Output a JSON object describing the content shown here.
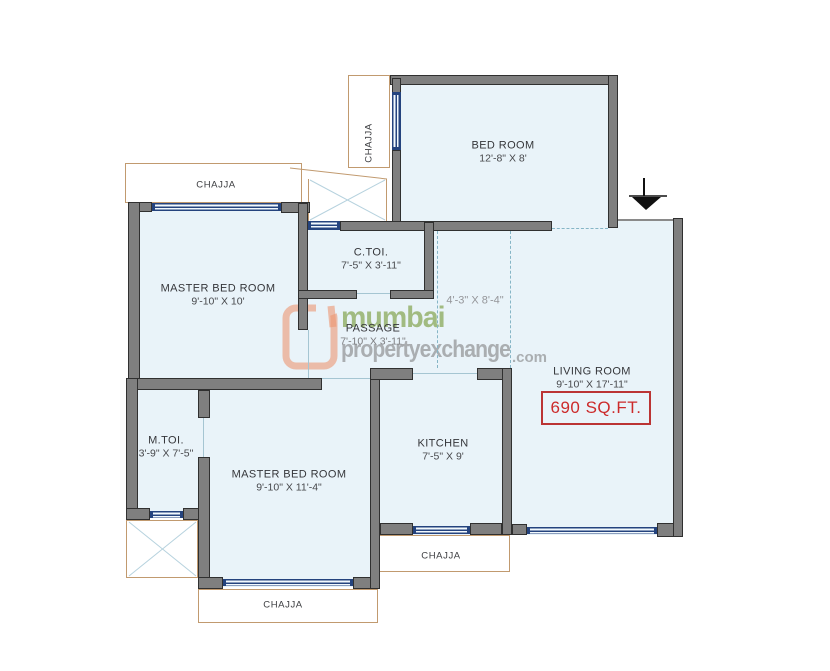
{
  "plan": {
    "area_badge": "690 SQ.FT.",
    "chajja_label": "CHAJJA",
    "rooms": {
      "bedroom": {
        "name": "BED ROOM",
        "dims": "12'-8\" X 8'"
      },
      "master_bed_top": {
        "name": "MASTER BED ROOM",
        "dims": "9'-10\" X 10'"
      },
      "common_toilet": {
        "name": "C.TOI.",
        "dims": "7'-5\" X 3'-11\""
      },
      "passage": {
        "name": "PASSAGE",
        "dims": "7'-10\" X 3'-11\""
      },
      "foyer": {
        "dims": "4'-3\" X 8'-4\""
      },
      "living": {
        "name": "LIVING ROOM",
        "dims": "9'-10\" X 17'-11\""
      },
      "kitchen": {
        "name": "KITCHEN",
        "dims": "7'-5\" X 9'"
      },
      "master_bed_bottom": {
        "name": "MASTER BED ROOM",
        "dims": "9'-10\" X 11'-4\""
      },
      "master_toilet": {
        "name": "M.TOI.",
        "dims": "3'-9\" X 7'-5\""
      }
    }
  },
  "watermark": {
    "brand_word": "mumbai",
    "brand_word2": "propertyexchange",
    "brand_suffix": ".com"
  },
  "colors": {
    "wall": "#7f7f7f",
    "window": "#24437e",
    "room_fill": "#e9f3f9",
    "chajja_outline": "#c19a6f",
    "area_text": "#cc2a2a",
    "watermark_green": "#94b06c",
    "watermark_gray": "#828385",
    "watermark_orange": "#ec9672"
  }
}
